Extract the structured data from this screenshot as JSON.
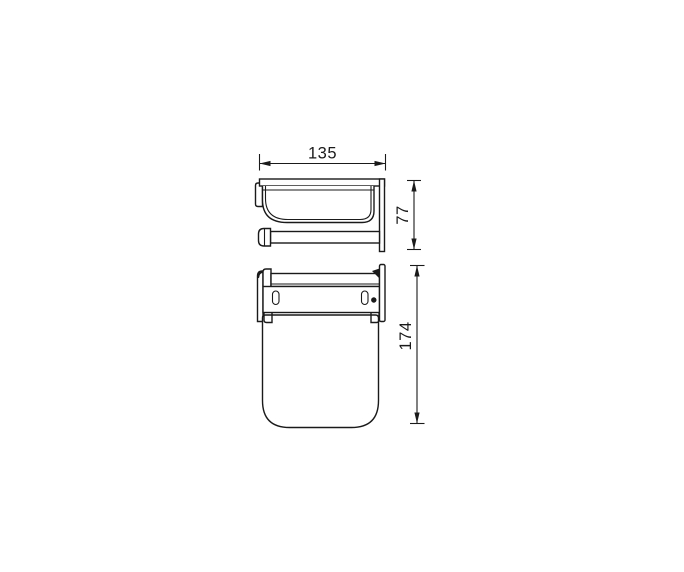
{
  "canvas": {
    "background": "#ffffff",
    "line_color": "#1a1a1a"
  },
  "dimensions": {
    "width": {
      "label": "135",
      "orientation": "horizontal",
      "view": "front"
    },
    "height": {
      "label": "77",
      "orientation": "vertical",
      "view": "front"
    },
    "depth": {
      "label": "174",
      "orientation": "vertical",
      "view": "top"
    }
  }
}
